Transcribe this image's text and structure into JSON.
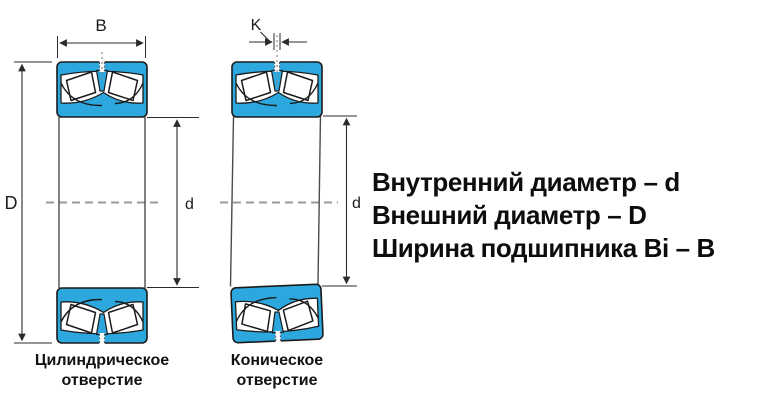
{
  "legend": {
    "line1": "Внутренний диаметр – d",
    "line2": "Внешний диаметр – D",
    "line3": "Ширина подшипника Bi – B"
  },
  "left_bearing": {
    "caption_line1": "Цилиндрическое",
    "caption_line2": "отверстие",
    "width_label": "B",
    "outer_diameter_label": "D",
    "bore_diameter_label": "d"
  },
  "right_bearing": {
    "caption_line1": "Коническое",
    "caption_line2": "отверстие",
    "slot_label": "K",
    "bore_diameter_label": "d"
  },
  "colors": {
    "bearing_fill": "#2CA8DF",
    "outline": "#1B1B1B",
    "dimension_line": "#2B2B2B",
    "centerline": "#9A9A9A"
  }
}
